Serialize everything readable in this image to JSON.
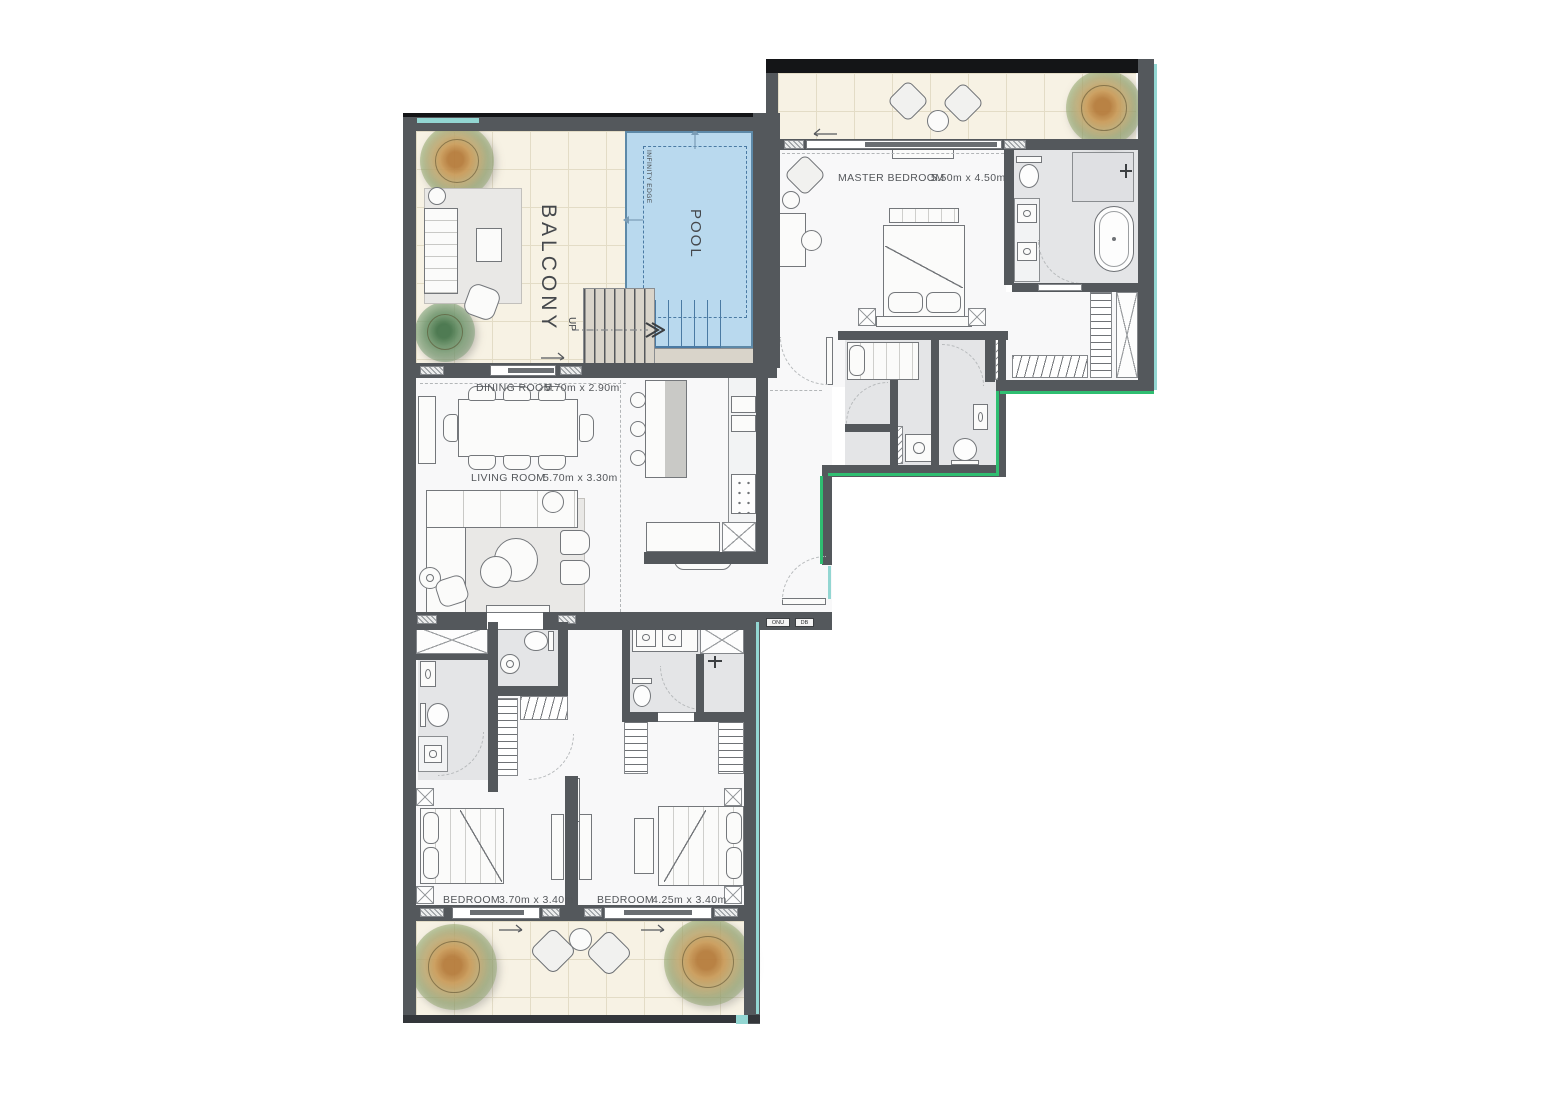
{
  "meta": {
    "title": "Apartment floor plan with pool"
  },
  "rooms": {
    "master_bedroom": {
      "name": "MASTER BEDROOM",
      "dims": "5.50m x 4.50m"
    },
    "dining_room": {
      "name": "DINING ROOM",
      "dims": "5.70m x 2.90m"
    },
    "living_room": {
      "name": "LIVING ROOM",
      "dims": "5.70m x 3.30m"
    },
    "bedroom_1": {
      "name": "BEDROOM",
      "dims": "3.70m x 3.40m"
    },
    "bedroom_2": {
      "name": "BEDROOM",
      "dims": "4.25m x 3.40m"
    },
    "balcony": {
      "name": "BALCONY"
    },
    "pool": {
      "name": "POOL"
    }
  },
  "annotations": {
    "infinity_edge": "INFINITY EDGE",
    "up": "UP",
    "onu": "ONU",
    "db": "DB"
  },
  "colors": {
    "wall": "#54585c",
    "wall_black": "#141517",
    "floor": "#f8f8f9",
    "wet_floor": "#e4e5e7",
    "tile_floor": "#f7f2e4",
    "pool_water": "#b9d9ee",
    "pool_edge": "#5d89a8",
    "stair_deck": "#d9d4ca",
    "glass_green": "#2fbe71",
    "glass_teal": "#93d6d2",
    "label_text": "#53565a"
  }
}
